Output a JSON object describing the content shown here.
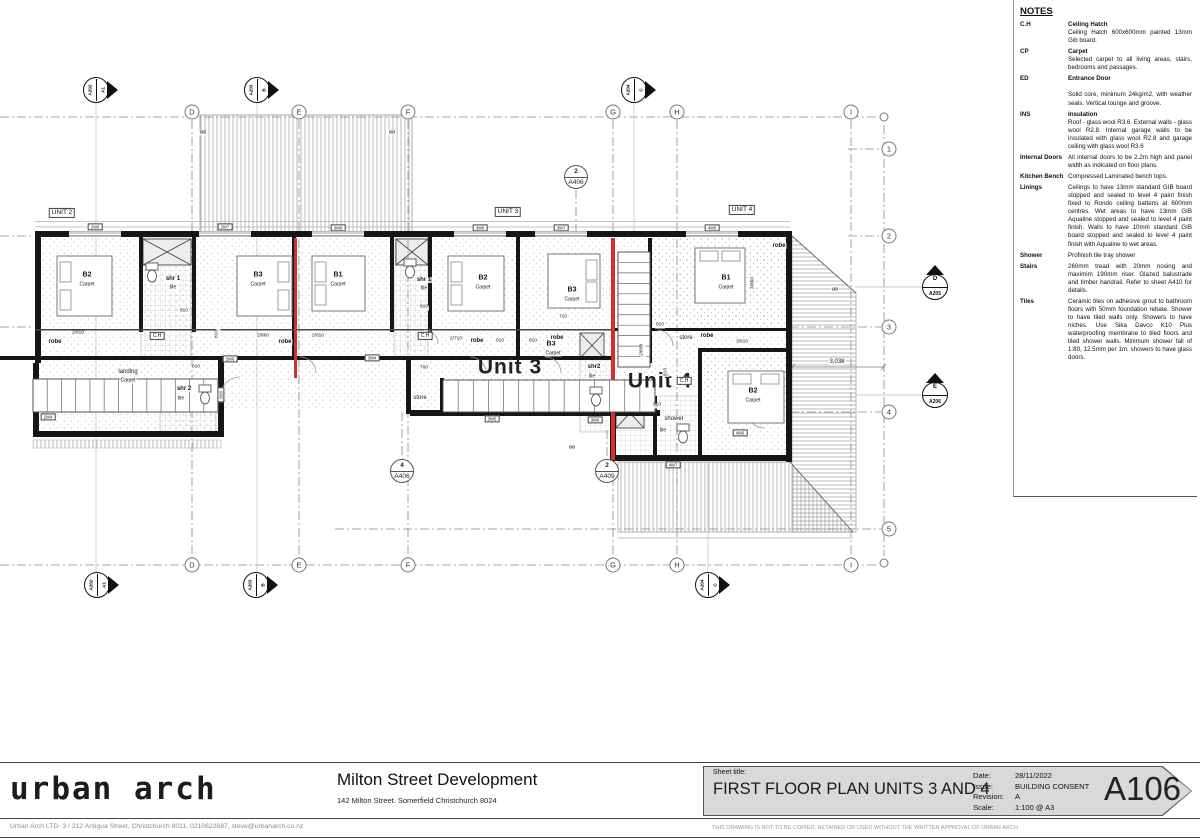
{
  "sheet": {
    "logo": "urban arch",
    "project_title": "Milton Street Development",
    "project_address": "142 Milton Street. Somerfield Christchurch 8024",
    "sheet_title_label": "Sheet title:",
    "sheet_title": "FIRST FLOOR PLAN UNITS 3 AND 4",
    "date_label": "Date:",
    "date": "28/11/2022",
    "issue_label": "Issue:",
    "issue": "BUILDING CONSENT",
    "revision_label": "Revision:",
    "revision": "A",
    "scale_label": "Scale:",
    "scale": "1:100 @ A3",
    "sheet_number": "A106",
    "firm_details": "Urban Arch LTD- 3 / 212 Antigua Street, Christchurch 8011, 0210622687, steve@urbanarch.co.nz",
    "copyright": "THIS DRAWING IS NOT TO BE COPIED, RETAINED OR USED WITHOUT THE WRITTEN APPROVAL OF URBAN ARCH"
  },
  "notes": {
    "title": "NOTES",
    "items": [
      {
        "abbr": "C.H",
        "term": "Ceiling Hatch",
        "desc": "Ceiling Hatch 600x600mm painted 13mm Gib board."
      },
      {
        "abbr": "CP",
        "term": "Carpet",
        "desc": "Selected carpet to all living areas, stairs, bedrooms and passages."
      },
      {
        "abbr": "ED",
        "term": "Entrance Door",
        "desc": "Solid core, minimum 24kg/m2, with weather seals. Vertical tounge and groove.",
        "gap": true
      },
      {
        "abbr": "INS",
        "term": "Insulation",
        "desc": "Roof - glass wool R3.6. External walls - glass wool R2.8. Internal garage walls to be insulated with glass wool R2.8 and garage ceiling with glass wool R3.6"
      },
      {
        "abbr": "Internal Doors",
        "term": "",
        "desc": "All internal doors to be 2.2m high and panel width as indicated on floor plans."
      },
      {
        "abbr": "Kitchen Bench",
        "term": "",
        "desc": "Compressed Laminated bench tops."
      },
      {
        "abbr": "Linings",
        "term": "",
        "desc": "Ceilings to have 13mm standard GIB board stopped and sealed to level 4 paint finish fixed to Rondo ceiling battens at 600mm centres. Wet areas to have 13mm GIB Aqualine stopped and sealed to level 4 paint finish. Walls to have 10mm standard GIB board stopped and sealed to level 4 paint finish with Aqualine to wet areas."
      },
      {
        "abbr": "Shower",
        "term": "",
        "desc": "Profinish tile tray shower"
      },
      {
        "abbr": "Stairs",
        "term": "",
        "desc": "260mm tread with 20mm nosing and maximim 190mm riser. Glazed balustrade and timber handrail. Refer to sheet A410 for details."
      },
      {
        "abbr": "Tiles",
        "term": "",
        "desc": "Ceramic tiles on adhesive grout to bathroom floors with 50mm foundation rebate. Shower to have tiled walls only. Showers to have niches. Use Sika Davco K10 Plus waterproofing membrane to tiled floors and tiled shower walls. Minimum shower fall of 1:80, 12.5mm per 1m. showers to have glass doors."
      }
    ]
  },
  "plan": {
    "colors": {
      "intertenancy_red": "#d32f2f"
    },
    "grid": {
      "cols": [
        {
          "t": "D",
          "x": 192
        },
        {
          "t": "E",
          "x": 299
        },
        {
          "t": "F",
          "x": 408
        },
        {
          "t": "G",
          "x": 613
        },
        {
          "t": "H",
          "x": 677
        },
        {
          "t": "I",
          "x": 851
        }
      ],
      "col_y_top": 112,
      "col_y_bottom": 565,
      "rows": [
        {
          "t": "1",
          "y": 149
        },
        {
          "t": "2",
          "y": 236
        },
        {
          "t": "3",
          "y": 327
        },
        {
          "t": "4",
          "y": 412
        },
        {
          "t": "5",
          "y": 529
        }
      ],
      "row_x": 889,
      "plain": [
        {
          "x": 884,
          "y": 117
        },
        {
          "x": 884,
          "y": 563
        }
      ]
    },
    "elev_markers": [
      {
        "label": "A1",
        "sheet": "A202",
        "x": 96,
        "y": 90
      },
      {
        "label": "B",
        "sheet": "A203",
        "x": 257,
        "y": 90
      },
      {
        "label": "C",
        "sheet": "A204",
        "x": 634,
        "y": 90
      },
      {
        "label": "A1",
        "sheet": "A202",
        "x": 97,
        "y": 585
      },
      {
        "label": "B",
        "sheet": "A203",
        "x": 256,
        "y": 585
      },
      {
        "label": "C",
        "sheet": "A204",
        "x": 708,
        "y": 585
      },
      {
        "label": "D",
        "sheet": "A205",
        "x": 935,
        "y": 287,
        "dir": "side"
      },
      {
        "label": "E",
        "sheet": "A206",
        "x": 935,
        "y": 395,
        "dir": "side"
      }
    ],
    "section_markers": [
      {
        "num": "2",
        "sheet": "A406",
        "x": 576,
        "y": 177
      },
      {
        "num": "4",
        "sheet": "A406",
        "x": 402,
        "y": 471
      },
      {
        "num": "2",
        "sheet": "A409",
        "x": 607,
        "y": 471
      }
    ],
    "window_wall_xs": [
      95,
      225,
      338,
      480,
      561,
      712
    ],
    "labels": [
      {
        "t": "UNIT 2",
        "x": 62,
        "y": 213,
        "s": 6.5,
        "k": "box",
        "n": "unit-2-tag"
      },
      {
        "t": "UNIT 3",
        "x": 508,
        "y": 212,
        "s": 6.5,
        "k": "box",
        "n": "unit-3-tag"
      },
      {
        "t": "UNIT 4",
        "x": 742,
        "y": 210,
        "s": 6.5,
        "k": "box",
        "n": "unit-4-tag"
      },
      {
        "t": "Unit 3",
        "x": 510,
        "y": 367,
        "s": 21,
        "w": 1,
        "big": 1,
        "n": "unit-3-label"
      },
      {
        "t": "Unit 4",
        "x": 660,
        "y": 381,
        "s": 21,
        "w": 1,
        "big": 1,
        "n": "unit-4-label"
      },
      {
        "t": "B2",
        "x": 87,
        "y": 275,
        "s": 7,
        "w": 1,
        "n": "room-b2-unit2"
      },
      {
        "t": "Carpet",
        "x": 87,
        "y": 285,
        "s": 5,
        "n": "room-finish"
      },
      {
        "t": "shr 1",
        "x": 173,
        "y": 279,
        "s": 6,
        "w": 1,
        "n": "room-shr1-unit2"
      },
      {
        "t": "tile",
        "x": 173,
        "y": 288,
        "s": 5,
        "n": "room-finish"
      },
      {
        "t": "B3",
        "x": 258,
        "y": 275,
        "s": 7,
        "w": 1,
        "n": "room-b3-unit2"
      },
      {
        "t": "Carpet",
        "x": 258,
        "y": 285,
        "s": 5,
        "n": "room-finish"
      },
      {
        "t": "B1",
        "x": 338,
        "y": 275,
        "s": 7,
        "w": 1,
        "n": "room-b1-unit3"
      },
      {
        "t": "Carpet",
        "x": 338,
        "y": 285,
        "s": 5,
        "n": "room-finish"
      },
      {
        "t": "shr 1",
        "x": 424,
        "y": 280,
        "s": 6,
        "w": 1,
        "n": "room-shr1-unit3"
      },
      {
        "t": "tile",
        "x": 424,
        "y": 289,
        "s": 5,
        "n": "room-finish"
      },
      {
        "t": "B2",
        "x": 483,
        "y": 278,
        "s": 7,
        "w": 1,
        "n": "room-b2-unit3"
      },
      {
        "t": "Carpet",
        "x": 483,
        "y": 288,
        "s": 5,
        "n": "room-finish"
      },
      {
        "t": "B3",
        "x": 572,
        "y": 290,
        "s": 7,
        "w": 1,
        "n": "room-b3-unit3"
      },
      {
        "t": "Carpet",
        "x": 572,
        "y": 300,
        "s": 5,
        "n": "room-finish"
      },
      {
        "t": "B3",
        "x": 551,
        "y": 344,
        "s": 7,
        "w": 1,
        "n": "room-b3-unit3-lower"
      },
      {
        "t": "Carpet",
        "x": 553,
        "y": 354,
        "s": 5,
        "n": "room-finish"
      },
      {
        "t": "B1",
        "x": 726,
        "y": 278,
        "s": 7,
        "w": 1,
        "n": "room-b1-unit4"
      },
      {
        "t": "Carpet",
        "x": 726,
        "y": 288,
        "s": 5,
        "n": "room-finish"
      },
      {
        "t": "B2",
        "x": 753,
        "y": 391,
        "s": 7,
        "w": 1,
        "n": "room-b2-unit4"
      },
      {
        "t": "Carpet",
        "x": 753,
        "y": 401,
        "s": 5,
        "n": "room-finish"
      },
      {
        "t": "landing",
        "x": 128,
        "y": 372,
        "s": 6,
        "n": "room-landing"
      },
      {
        "t": "Carpet",
        "x": 128,
        "y": 381,
        "s": 5,
        "n": "room-finish"
      },
      {
        "t": "shr 2",
        "x": 184,
        "y": 389,
        "s": 6,
        "w": 1,
        "n": "room-shr2-unit2"
      },
      {
        "t": "tile",
        "x": 181,
        "y": 399,
        "s": 5,
        "n": "room-finish"
      },
      {
        "t": "shr2",
        "x": 594,
        "y": 367,
        "s": 6,
        "w": 1,
        "n": "room-shr2-unit3"
      },
      {
        "t": "tile",
        "x": 592,
        "y": 377,
        "s": 5,
        "n": "room-finish"
      },
      {
        "t": "store",
        "x": 420,
        "y": 398,
        "s": 6,
        "n": "room-store-unit3"
      },
      {
        "t": "store",
        "x": 686,
        "y": 338,
        "s": 6,
        "n": "room-store-unit4"
      },
      {
        "t": "shower",
        "x": 674,
        "y": 419,
        "s": 6,
        "n": "room-shower-unit4"
      },
      {
        "t": "tile",
        "x": 663,
        "y": 431,
        "s": 5,
        "n": "room-finish"
      },
      {
        "t": "robe",
        "x": 55,
        "y": 342,
        "s": 6,
        "w": 1,
        "n": "robe-label"
      },
      {
        "t": "robe",
        "x": 285,
        "y": 342,
        "s": 6,
        "w": 1,
        "n": "robe-label"
      },
      {
        "t": "robe",
        "x": 477,
        "y": 341,
        "s": 6,
        "w": 1,
        "n": "robe-label"
      },
      {
        "t": "robe",
        "x": 557,
        "y": 338,
        "s": 6,
        "w": 1,
        "n": "robe-label"
      },
      {
        "t": "robe",
        "x": 707,
        "y": 336,
        "s": 6,
        "w": 1,
        "n": "robe-label"
      },
      {
        "t": "robe",
        "x": 779,
        "y": 246,
        "s": 6,
        "w": 1,
        "n": "robe-label"
      },
      {
        "t": "C.H",
        "x": 157,
        "y": 336,
        "s": 5,
        "k": "box",
        "n": "ceiling-hatch-tag"
      },
      {
        "t": "C.H",
        "x": 425,
        "y": 336,
        "s": 5,
        "k": "box",
        "n": "ceiling-hatch-tag"
      },
      {
        "t": "C.H",
        "x": 684,
        "y": 381,
        "s": 5,
        "k": "box",
        "n": "ceiling-hatch-tag"
      },
      {
        "t": "2/910",
        "x": 78,
        "y": 334,
        "s": 4.8,
        "n": "dim"
      },
      {
        "t": "810",
        "x": 184,
        "y": 312,
        "s": 4.8,
        "n": "dim"
      },
      {
        "t": "810",
        "x": 218,
        "y": 334,
        "s": 4.8,
        "r": -90,
        "n": "dim"
      },
      {
        "t": "810",
        "x": 196,
        "y": 368,
        "s": 4.8,
        "n": "dim"
      },
      {
        "t": "2/660",
        "x": 263,
        "y": 337,
        "s": 4.8,
        "n": "dim"
      },
      {
        "t": "2/810",
        "x": 318,
        "y": 337,
        "s": 4.8,
        "n": "dim"
      },
      {
        "t": "810",
        "x": 424,
        "y": 308,
        "s": 4.8,
        "n": "dim"
      },
      {
        "t": "2/710",
        "x": 456,
        "y": 340,
        "s": 4.8,
        "n": "dim"
      },
      {
        "t": "810",
        "x": 500,
        "y": 342,
        "s": 4.8,
        "n": "dim"
      },
      {
        "t": "810",
        "x": 533,
        "y": 342,
        "s": 4.8,
        "n": "dim"
      },
      {
        "t": "710",
        "x": 563,
        "y": 318,
        "s": 4.8,
        "n": "dim"
      },
      {
        "t": "760",
        "x": 424,
        "y": 369,
        "s": 4.8,
        "n": "dim"
      },
      {
        "t": "810",
        "x": 660,
        "y": 326,
        "s": 4.8,
        "n": "dim"
      },
      {
        "t": "810",
        "x": 657,
        "y": 406,
        "s": 4.8,
        "n": "dim"
      },
      {
        "t": "810",
        "x": 667,
        "y": 372,
        "s": 4.8,
        "r": -90,
        "n": "dim"
      },
      {
        "t": "2/608",
        "x": 643,
        "y": 350,
        "s": 4.8,
        "r": -90,
        "n": "dim"
      },
      {
        "t": "3/910",
        "x": 742,
        "y": 343,
        "s": 4.8,
        "n": "dim"
      },
      {
        "t": "3/860",
        "x": 754,
        "y": 283,
        "s": 4.8,
        "r": -90,
        "n": "dim"
      },
      {
        "t": "3,038",
        "x": 837,
        "y": 362,
        "s": 6,
        "n": "dim"
      },
      {
        "t": "2W6",
        "x": 95,
        "y": 227,
        "s": 4.2,
        "k": "box",
        "n": "window-tag"
      },
      {
        "t": "2W7",
        "x": 225,
        "y": 227,
        "s": 4.2,
        "k": "box",
        "n": "window-tag"
      },
      {
        "t": "3W8",
        "x": 338,
        "y": 228,
        "s": 4.2,
        "k": "box",
        "n": "window-tag"
      },
      {
        "t": "3W6",
        "x": 480,
        "y": 228,
        "s": 4.2,
        "k": "box",
        "n": "window-tag"
      },
      {
        "t": "3W7",
        "x": 561,
        "y": 228,
        "s": 4.2,
        "k": "box",
        "n": "window-tag"
      },
      {
        "t": "4W5",
        "x": 712,
        "y": 228,
        "s": 4.2,
        "k": "box",
        "n": "window-tag"
      },
      {
        "t": "2W4",
        "x": 48,
        "y": 417,
        "s": 4.2,
        "k": "box",
        "n": "window-tag"
      },
      {
        "t": "2W6",
        "x": 230,
        "y": 359,
        "s": 4.2,
        "k": "box",
        "n": "window-tag"
      },
      {
        "t": "2W5",
        "x": 221,
        "y": 395,
        "s": 4.2,
        "r": -90,
        "k": "box",
        "n": "window-tag"
      },
      {
        "t": "3W4",
        "x": 372,
        "y": 358,
        "s": 4.2,
        "k": "box",
        "n": "window-tag"
      },
      {
        "t": "3W5",
        "x": 492,
        "y": 419,
        "s": 4.2,
        "k": "box",
        "n": "window-tag"
      },
      {
        "t": "3W6",
        "x": 595,
        "y": 420,
        "s": 4.2,
        "k": "box",
        "n": "window-tag"
      },
      {
        "t": "4W7",
        "x": 673,
        "y": 465,
        "s": 4.2,
        "k": "box",
        "n": "window-tag"
      },
      {
        "t": "4W6",
        "x": 740,
        "y": 433,
        "s": 4.2,
        "k": "box",
        "n": "window-tag"
      },
      {
        "t": "øø",
        "x": 203,
        "y": 133,
        "s": 5,
        "n": "downpipe-symbol"
      },
      {
        "t": "øø",
        "x": 392,
        "y": 133,
        "s": 5,
        "n": "downpipe-symbol"
      },
      {
        "t": "øø",
        "x": 572,
        "y": 448,
        "s": 5,
        "n": "downpipe-symbol"
      },
      {
        "t": "øø",
        "x": 835,
        "y": 290,
        "s": 5,
        "n": "downpipe-symbol"
      }
    ]
  }
}
